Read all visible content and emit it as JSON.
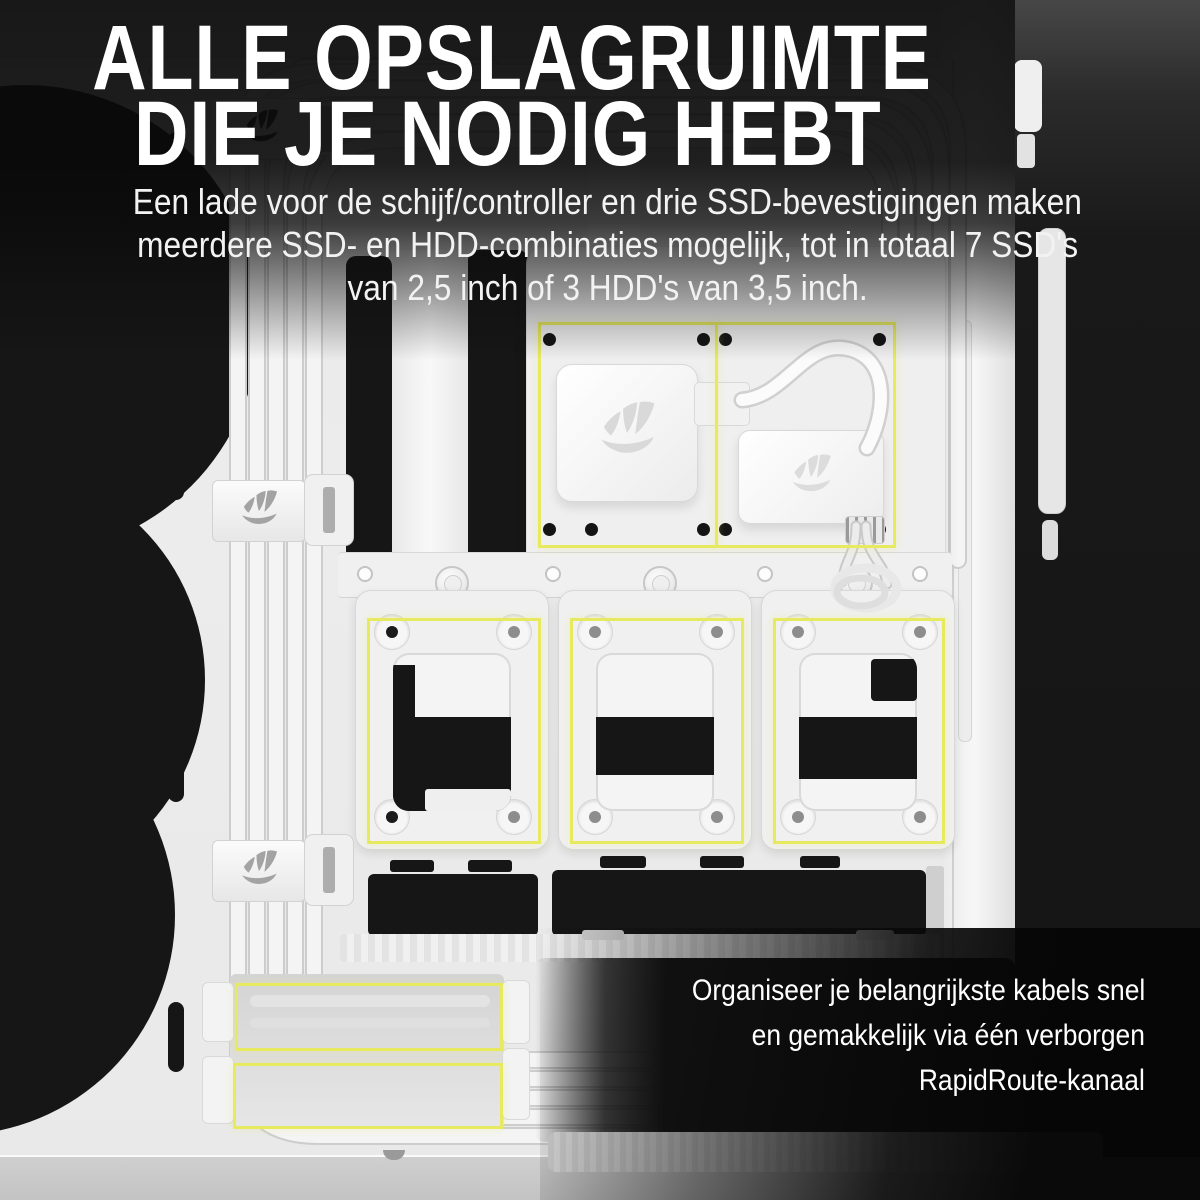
{
  "overlay": {
    "headline": [
      "ALLE OPSLAGRUIMTE",
      "DIE JE NODIG HEBT"
    ],
    "subheadline": [
      "Een lade voor de schijf/controller en drie SSD-bevestigingen maken",
      "meerdere SSD- en HDD-combinaties mogelijk, tot in totaal 7 SSD's",
      "van 2,5 inch of 3 HDD's van 3,5 inch."
    ],
    "callout": [
      "Organiseer je belangrijkste kabels snel",
      "en gemakkelijk via één verborgen",
      "RapidRoute-kanaal"
    ]
  },
  "colors": {
    "highlight": "#e7ea5e",
    "case_white": "#ececec",
    "cutout_black": "#161616",
    "text": "#ffffff"
  },
  "figure": {
    "type": "product-photo",
    "annotations": [
      {
        "name": "drive-controller-tray-bay-left"
      },
      {
        "name": "drive-controller-tray-bay-right"
      },
      {
        "name": "ssd-mount-1"
      },
      {
        "name": "ssd-mount-2"
      },
      {
        "name": "ssd-mount-3"
      },
      {
        "name": "rapidroute-channel-upper"
      },
      {
        "name": "rapidroute-channel-lower"
      }
    ]
  }
}
